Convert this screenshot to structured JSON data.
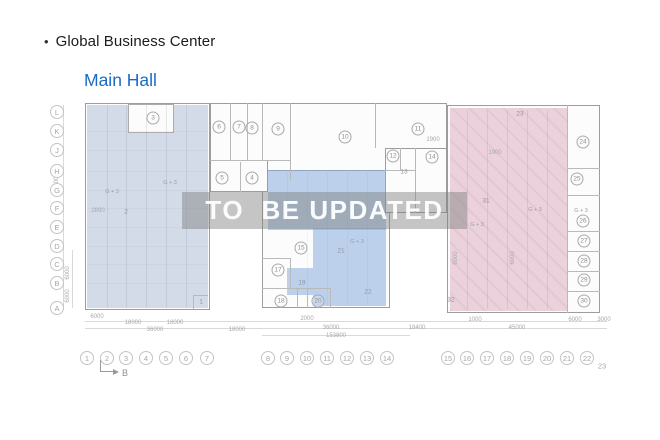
{
  "header": {
    "bullet": "•",
    "title": "Global Business Center",
    "subtitle": "Main Hall"
  },
  "watermark": {
    "text": "TO  BE UPDATED"
  },
  "colors": {
    "subtitle_blue": "#1a6bc4",
    "shade_left": "#cdd5df",
    "shade_middle": "#b9cfe9",
    "shade_right": "#e9cdd8",
    "watermark_band": "#7e7e7e",
    "watermark_text": "#ffffff",
    "wall_gray": "#9d9d9d"
  },
  "plan": {
    "section_marker": {
      "label": "B"
    },
    "row_labels": [
      {
        "t": "L",
        "y": 112
      },
      {
        "t": "K",
        "y": 131
      },
      {
        "t": "J",
        "y": 150
      },
      {
        "t": "H",
        "y": 171
      },
      {
        "t": "G",
        "y": 190
      },
      {
        "t": "F",
        "y": 208
      },
      {
        "t": "E",
        "y": 227
      },
      {
        "t": "D",
        "y": 246
      },
      {
        "t": "C",
        "y": 264
      },
      {
        "t": "B",
        "y": 283
      },
      {
        "t": "A",
        "y": 308
      }
    ],
    "col_labels": [
      {
        "t": "1",
        "x": 87
      },
      {
        "t": "2",
        "x": 107
      },
      {
        "t": "3",
        "x": 126
      },
      {
        "t": "4",
        "x": 146
      },
      {
        "t": "5",
        "x": 166
      },
      {
        "t": "6",
        "x": 186
      },
      {
        "t": "7",
        "x": 207
      },
      {
        "t": "8",
        "x": 268
      },
      {
        "t": "9",
        "x": 287
      },
      {
        "t": "10",
        "x": 307
      },
      {
        "t": "11",
        "x": 327
      },
      {
        "t": "12",
        "x": 347
      },
      {
        "t": "13",
        "x": 367
      },
      {
        "t": "14",
        "x": 387
      },
      {
        "t": "15",
        "x": 448
      },
      {
        "t": "16",
        "x": 467
      },
      {
        "t": "17",
        "x": 487
      },
      {
        "t": "18",
        "x": 507
      },
      {
        "t": "19",
        "x": 527
      },
      {
        "t": "20",
        "x": 547
      },
      {
        "t": "21",
        "x": 567
      },
      {
        "t": "22",
        "x": 587
      },
      {
        "t": "23",
        "x": 602,
        "y": 366,
        "plain": true
      }
    ],
    "rooms": [
      {
        "t": "3",
        "x": 153,
        "y": 118
      },
      {
        "t": "6",
        "x": 219,
        "y": 127
      },
      {
        "t": "7",
        "x": 239,
        "y": 127
      },
      {
        "t": "8",
        "x": 252,
        "y": 128
      },
      {
        "t": "9",
        "x": 278,
        "y": 129
      },
      {
        "t": "10",
        "x": 345,
        "y": 137
      },
      {
        "t": "11",
        "x": 418,
        "y": 129
      },
      {
        "t": "12",
        "x": 393,
        "y": 156
      },
      {
        "t": "14",
        "x": 432,
        "y": 157
      },
      {
        "t": "5",
        "x": 222,
        "y": 178
      },
      {
        "t": "4",
        "x": 252,
        "y": 178
      },
      {
        "t": "15",
        "x": 301,
        "y": 248
      },
      {
        "t": "17",
        "x": 278,
        "y": 270
      },
      {
        "t": "18",
        "x": 281,
        "y": 301
      },
      {
        "t": "20",
        "x": 318,
        "y": 301
      },
      {
        "t": "24",
        "x": 583,
        "y": 142
      },
      {
        "t": "25",
        "x": 577,
        "y": 179
      },
      {
        "t": "26",
        "x": 583,
        "y": 221
      },
      {
        "t": "27",
        "x": 584,
        "y": 241
      },
      {
        "t": "28",
        "x": 584,
        "y": 261
      },
      {
        "t": "29",
        "x": 584,
        "y": 280
      },
      {
        "t": "30",
        "x": 584,
        "y": 301
      }
    ],
    "plain_labels": [
      {
        "t": "2",
        "x": 126,
        "y": 212
      },
      {
        "t": "1",
        "x": 201,
        "y": 302
      },
      {
        "t": "13",
        "x": 404,
        "y": 172
      },
      {
        "t": "19",
        "x": 302,
        "y": 283
      },
      {
        "t": "21",
        "x": 341,
        "y": 251
      },
      {
        "t": "22",
        "x": 368,
        "y": 292
      },
      {
        "t": "31",
        "x": 486,
        "y": 201
      },
      {
        "t": "32",
        "x": 451,
        "y": 300
      },
      {
        "t": "23",
        "x": 520,
        "y": 114
      }
    ],
    "annotations": [
      {
        "t": "G + 3",
        "x": 112,
        "y": 192
      },
      {
        "t": "G + 3",
        "x": 170,
        "y": 183
      },
      {
        "t": "G + 3",
        "x": 357,
        "y": 242
      },
      {
        "t": "G + 3",
        "x": 535,
        "y": 210
      },
      {
        "t": "G + 3",
        "x": 581,
        "y": 211
      },
      {
        "t": "G + 3",
        "x": 477,
        "y": 225
      }
    ],
    "dimensions": [
      {
        "t": "6000",
        "x": 97,
        "y": 317
      },
      {
        "t": "18000",
        "x": 133,
        "y": 323
      },
      {
        "t": "18000",
        "x": 175,
        "y": 323
      },
      {
        "t": "36000",
        "x": 155,
        "y": 330
      },
      {
        "t": "18000",
        "x": 237,
        "y": 330
      },
      {
        "t": "2000",
        "x": 307,
        "y": 319
      },
      {
        "t": "36000",
        "x": 331,
        "y": 328
      },
      {
        "t": "153800",
        "x": 336,
        "y": 336
      },
      {
        "t": "18400",
        "x": 417,
        "y": 328
      },
      {
        "t": "1000",
        "x": 475,
        "y": 320
      },
      {
        "t": "45000",
        "x": 517,
        "y": 328
      },
      {
        "t": "6000",
        "x": 575,
        "y": 320
      },
      {
        "t": "3000",
        "x": 604,
        "y": 320
      },
      {
        "t": "2890",
        "x": 98,
        "y": 211
      },
      {
        "t": "1900",
        "x": 433,
        "y": 140
      },
      {
        "t": "1900",
        "x": 495,
        "y": 153
      },
      {
        "t": "60000",
        "x": 57,
        "y": 185,
        "rot": true
      },
      {
        "t": "6000",
        "x": 68,
        "y": 273,
        "rot": true
      },
      {
        "t": "6000",
        "x": 68,
        "y": 296,
        "rot": true
      },
      {
        "t": "6000",
        "x": 456,
        "y": 258,
        "rot": true
      },
      {
        "t": "6000",
        "x": 513,
        "y": 258,
        "rot": true
      }
    ],
    "buildings": [
      {
        "x": 85,
        "y": 103,
        "w": 125,
        "h": 207
      },
      {
        "x": 210,
        "y": 103,
        "w": 237,
        "h": 77
      },
      {
        "x": 447,
        "y": 105,
        "w": 153,
        "h": 208
      },
      {
        "x": 262,
        "y": 170,
        "w": 128,
        "h": 138
      },
      {
        "x": 210,
        "y": 160,
        "w": 58,
        "h": 32
      },
      {
        "x": 385,
        "y": 148,
        "w": 62,
        "h": 65
      }
    ],
    "shades": [
      {
        "k": "left",
        "x": 87,
        "y": 105,
        "w": 121,
        "h": 203
      },
      {
        "k": "white",
        "x": 128,
        "y": 104,
        "w": 44,
        "h": 27
      },
      {
        "k": "mid",
        "x": 268,
        "y": 170,
        "w": 118,
        "h": 60
      },
      {
        "k": "mid",
        "x": 313,
        "y": 228,
        "w": 73,
        "h": 78
      },
      {
        "k": "mid",
        "x": 287,
        "y": 268,
        "w": 26,
        "h": 27
      },
      {
        "k": "pink",
        "x": 450,
        "y": 108,
        "w": 117,
        "h": 203
      }
    ],
    "lines": [
      {
        "x": 230,
        "y": 103,
        "w": 1,
        "h": 57
      },
      {
        "x": 247,
        "y": 103,
        "w": 1,
        "h": 57
      },
      {
        "x": 262,
        "y": 103,
        "w": 1,
        "h": 57
      },
      {
        "x": 290,
        "y": 103,
        "w": 1,
        "h": 77
      },
      {
        "x": 375,
        "y": 103,
        "w": 1,
        "h": 45
      },
      {
        "x": 210,
        "y": 160,
        "w": 80,
        "h": 1
      },
      {
        "x": 240,
        "y": 162,
        "w": 1,
        "h": 30
      },
      {
        "x": 400,
        "y": 148,
        "w": 1,
        "h": 22
      },
      {
        "x": 385,
        "y": 170,
        "w": 30,
        "h": 1
      },
      {
        "x": 415,
        "y": 148,
        "w": 1,
        "h": 65
      },
      {
        "x": 262,
        "y": 258,
        "w": 28,
        "h": 1
      },
      {
        "x": 290,
        "y": 258,
        "w": 1,
        "h": 30
      },
      {
        "x": 262,
        "y": 288,
        "w": 68,
        "h": 1
      },
      {
        "x": 297,
        "y": 288,
        "w": 1,
        "h": 20
      },
      {
        "x": 307,
        "y": 288,
        "w": 1,
        "h": 20
      },
      {
        "x": 330,
        "y": 288,
        "w": 1,
        "h": 20
      },
      {
        "x": 567,
        "y": 105,
        "w": 1,
        "h": 208
      },
      {
        "x": 567,
        "y": 168,
        "w": 33,
        "h": 1
      },
      {
        "x": 567,
        "y": 195,
        "w": 33,
        "h": 1
      },
      {
        "x": 567,
        "y": 231,
        "w": 33,
        "h": 1
      },
      {
        "x": 567,
        "y": 251,
        "w": 33,
        "h": 1
      },
      {
        "x": 567,
        "y": 271,
        "w": 33,
        "h": 1
      },
      {
        "x": 567,
        "y": 291,
        "w": 33,
        "h": 1
      },
      {
        "x": 193,
        "y": 295,
        "w": 15,
        "h": 1
      },
      {
        "x": 193,
        "y": 295,
        "w": 1,
        "h": 14
      }
    ],
    "faint_lines": [
      {
        "x": 107,
        "y": 105,
        "w": 1,
        "h": 203
      },
      {
        "x": 126,
        "y": 105,
        "w": 1,
        "h": 203
      },
      {
        "x": 146,
        "y": 105,
        "w": 1,
        "h": 203
      },
      {
        "x": 166,
        "y": 105,
        "w": 1,
        "h": 203
      },
      {
        "x": 186,
        "y": 105,
        "w": 1,
        "h": 203
      },
      {
        "x": 87,
        "y": 131,
        "w": 121,
        "h": 1,
        "f2": true
      },
      {
        "x": 87,
        "y": 150,
        "w": 121,
        "h": 1,
        "f2": true
      },
      {
        "x": 87,
        "y": 171,
        "w": 121,
        "h": 1,
        "f2": true
      },
      {
        "x": 87,
        "y": 190,
        "w": 121,
        "h": 1,
        "f2": true
      },
      {
        "x": 87,
        "y": 208,
        "w": 121,
        "h": 1,
        "f2": true
      },
      {
        "x": 87,
        "y": 227,
        "w": 121,
        "h": 1,
        "f2": true
      },
      {
        "x": 87,
        "y": 246,
        "w": 121,
        "h": 1,
        "f2": true
      },
      {
        "x": 87,
        "y": 264,
        "w": 121,
        "h": 1,
        "f2": true
      },
      {
        "x": 87,
        "y": 283,
        "w": 121,
        "h": 1,
        "f2": true
      },
      {
        "x": 467,
        "y": 110,
        "w": 1,
        "h": 199
      },
      {
        "x": 487,
        "y": 110,
        "w": 1,
        "h": 199
      },
      {
        "x": 507,
        "y": 110,
        "w": 1,
        "h": 199
      },
      {
        "x": 527,
        "y": 110,
        "w": 1,
        "h": 199
      },
      {
        "x": 547,
        "y": 110,
        "w": 1,
        "h": 199
      },
      {
        "x": 287,
        "y": 172,
        "w": 1,
        "h": 56,
        "f2": true
      },
      {
        "x": 307,
        "y": 172,
        "w": 1,
        "h": 134,
        "f2": true
      },
      {
        "x": 327,
        "y": 172,
        "w": 1,
        "h": 134,
        "f2": true
      },
      {
        "x": 347,
        "y": 172,
        "w": 1,
        "h": 134,
        "f2": true
      },
      {
        "x": 367,
        "y": 172,
        "w": 1,
        "h": 134,
        "f2": true
      }
    ],
    "dim_guides": [
      {
        "x": 85,
        "y": 321,
        "w": 522,
        "h": 1
      },
      {
        "x": 85,
        "y": 328,
        "w": 522,
        "h": 1
      },
      {
        "x": 262,
        "y": 335,
        "w": 148,
        "h": 1
      },
      {
        "x": 63,
        "y": 105,
        "w": 1,
        "h": 205
      },
      {
        "x": 72,
        "y": 250,
        "w": 1,
        "h": 58
      }
    ]
  }
}
